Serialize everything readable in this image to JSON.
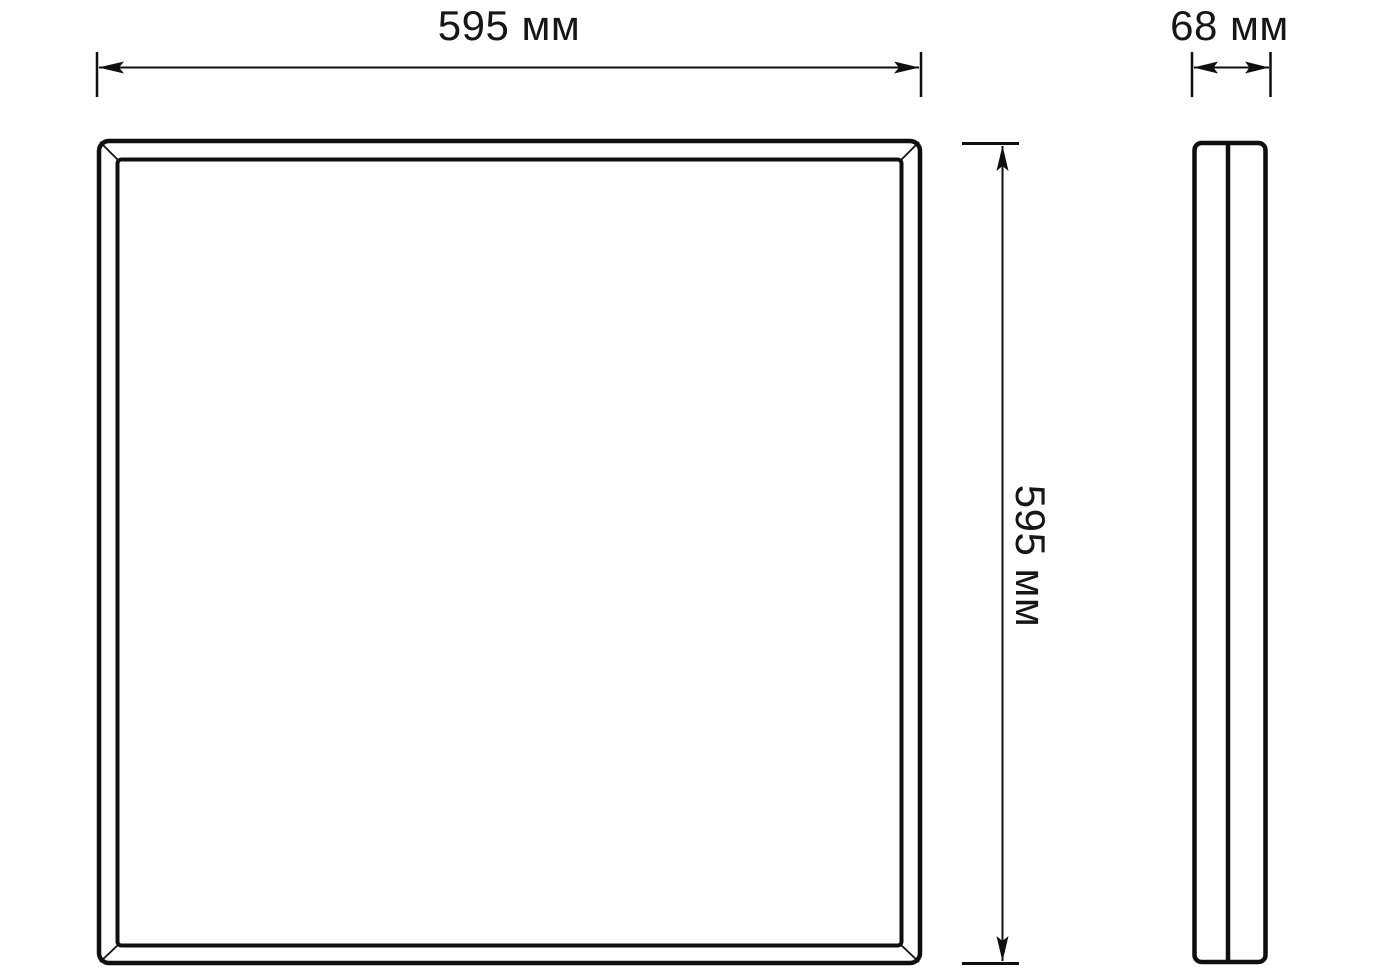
{
  "drawing": {
    "background_color": "#ffffff",
    "line_color": "#0f0f0f",
    "front_view": {
      "width_label": "595 мм",
      "height_label": "595 мм"
    },
    "side_view": {
      "depth_label": "68 мм"
    }
  }
}
